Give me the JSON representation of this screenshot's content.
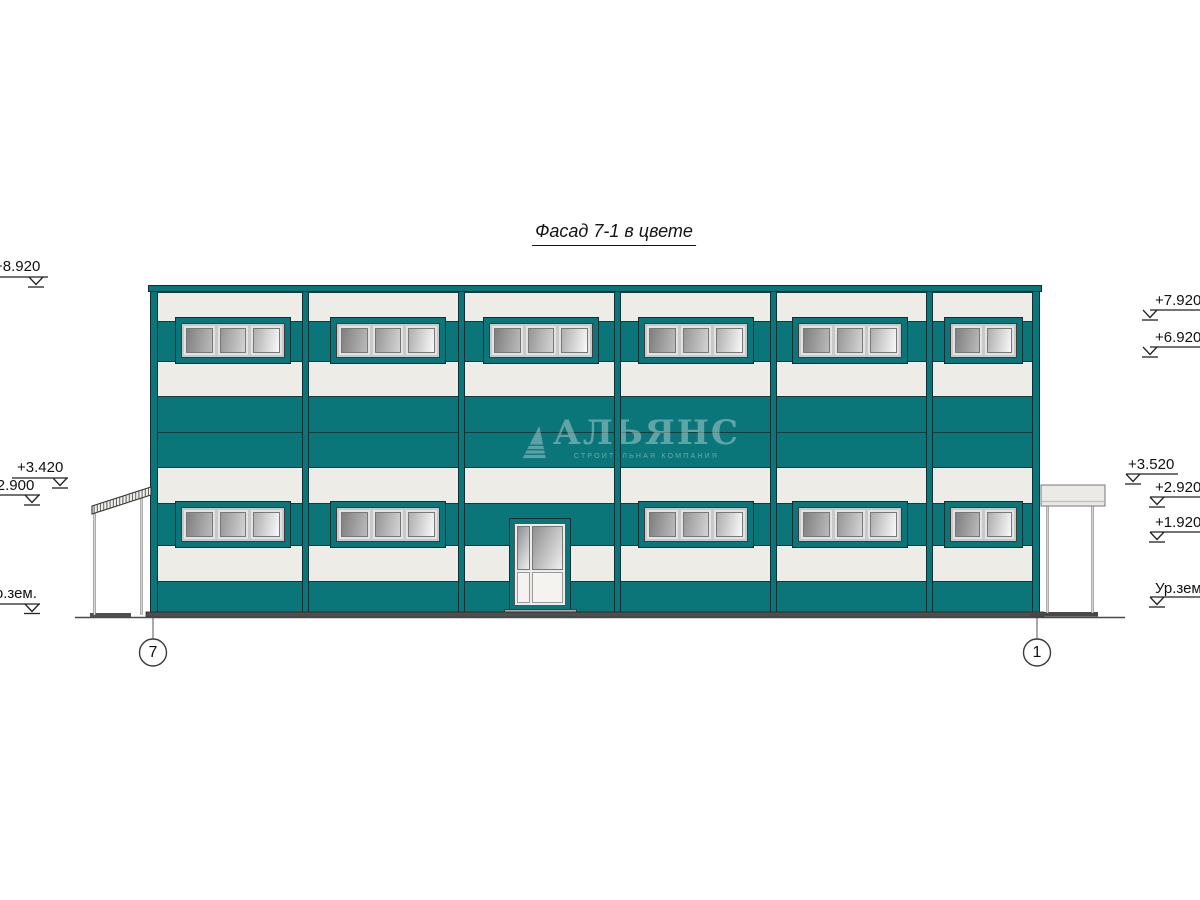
{
  "drawing": {
    "title": "Фасад 7-1 в цвете",
    "elevation_marks_left": [
      "+8.920",
      "+3.420",
      "+2.900",
      "Ур.зем."
    ],
    "elevation_marks_right": [
      "+7.920",
      "+6.920",
      "+3.520",
      "+2.920",
      "+1.920",
      "Ур.зем."
    ],
    "axis_bubbles": [
      "7",
      "1"
    ],
    "watermark": {
      "name": "АЛЬЯНС",
      "subtitle": "СТРОИТЕЛЬНАЯ КОМПАНИЯ"
    },
    "colors": {
      "facade_teal": "#0b767a",
      "facade_offwhite": "#edece6",
      "outline_dark": "#123034",
      "glass_gray": "#9a9a9a",
      "base_gray": "#4f4f4f"
    }
  }
}
